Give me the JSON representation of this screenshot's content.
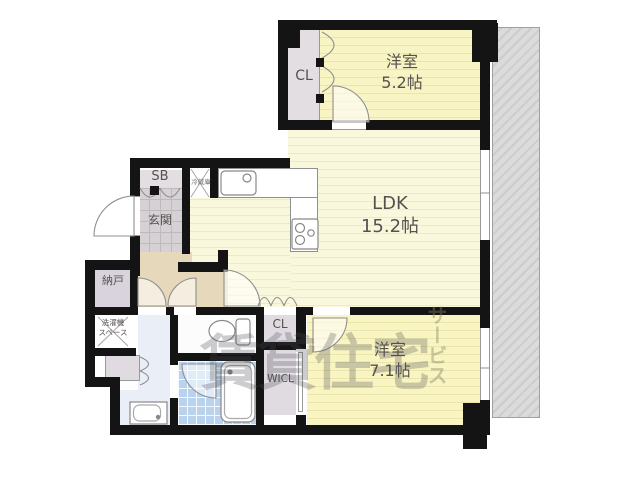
{
  "floorplan": {
    "rooms": {
      "bedroom_top": {
        "name": "洋室",
        "size": "5.2帖"
      },
      "ldk": {
        "name": "LDK",
        "size": "15.2帖"
      },
      "bedroom_bottom": {
        "name": "洋室",
        "size": "7.1帖"
      },
      "entrance": {
        "name": "玄関"
      },
      "storage": {
        "name": "納戸"
      },
      "laundry": {
        "name": "洗濯機\nスペース"
      },
      "shoe_box": {
        "name": "SB"
      },
      "closet_top": {
        "name": "CL"
      },
      "closet_bottom": {
        "name": "CL"
      },
      "walk_in_closet": {
        "name": "WICL"
      },
      "refrigerator": {
        "name": "冷蔵庫"
      }
    },
    "watermark": {
      "main": "賃貸住宅",
      "vertical": "サービス"
    },
    "colors": {
      "bedroom_yellow": "#f8f4c4",
      "ldk_yellow": "#faf8dc",
      "wall_black": "#141414",
      "hall_tan": "#e6d8bb",
      "storage_lavender": "#d9d3dd",
      "bath_blue": "#b9d3ee",
      "washroom_blue": "#eaeff7",
      "closet_gray": "#e2dee2",
      "entrance_tile_gray": "#d5d1d5",
      "balcony_gray": "#d7d7d7"
    }
  }
}
